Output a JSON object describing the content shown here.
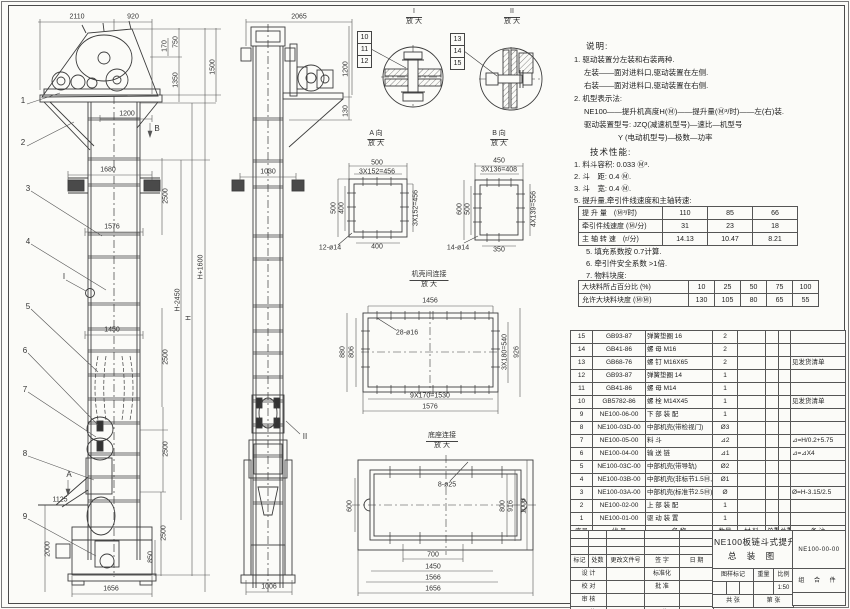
{
  "views": {
    "detail1": {
      "label": "I",
      "mag": "放 大"
    },
    "detail2": {
      "label": "II",
      "mag": "放 大"
    },
    "viewA": {
      "label": "A 向",
      "mag": "放 大"
    },
    "viewB": {
      "label": "B 向",
      "mag": "放 大"
    },
    "case_joint": {
      "label": "机壳间连接",
      "mag": "放 大"
    },
    "base_joint": {
      "label": "底座连接",
      "mag": "放 大"
    }
  },
  "markers": {
    "i": "I",
    "ii": "II",
    "a": "A",
    "b": "B"
  },
  "balloons": {
    "n1": "1",
    "n2": "2",
    "n3": "3",
    "n4": "4",
    "n5": "5",
    "n6": "6",
    "n7": "7",
    "n8": "8",
    "n9": "9",
    "n10": "10",
    "n11": "11",
    "n12": "12",
    "n13": "13",
    "n14": "14",
    "n15": "15"
  },
  "dims": {
    "fv_2110": "2110",
    "fv_920": "920",
    "fv_170": "170",
    "fv_750": "750",
    "fv_1350": "1350",
    "fv_1500": "1500",
    "fv_1200": "1200",
    "fv_1680": "1680",
    "fv_2500a": "2500",
    "fv_1576": "1576",
    "fv_h1600": "H+1600",
    "fv_h2450": "H-2450",
    "fv_h": "H",
    "fv_1450": "1450",
    "fv_2500b": "2500",
    "fv_2500c": "2500",
    "fv_2500d": "2500",
    "fv_850": "850",
    "fv_1125": "1125",
    "fv_2000": "2000",
    "fv_1656": "1656",
    "sv_2065": "2065",
    "sv_1200": "1200",
    "sv_130": "130",
    "sv_1030": "1030",
    "sv_1006": "1006",
    "va_500t": "500",
    "va_456t": "3X152=456",
    "va_500l": "500",
    "va_400l": "400",
    "va_456r": "3X152=456",
    "va_hole": "12-ø14",
    "va_400b": "400",
    "vb_450": "450",
    "vb_408": "3X136=408",
    "vb_600": "600",
    "vb_500": "500",
    "vb_556": "4X139=556",
    "vb_hole": "14-ø14",
    "vb_350": "350",
    "cj_1456": "1456",
    "cj_hole": "28-ø16",
    "cj_880": "880",
    "cj_806": "806",
    "cj_540": "3X180=540",
    "cj_926": "926",
    "cj_1530": "9X170=1530",
    "cj_1576": "1576",
    "bj_hole": "8-ø25",
    "bj_600": "600",
    "bj_800": "800",
    "bj_916": "916",
    "bj_1006": "1006",
    "bj_700": "700",
    "bj_1450": "1450",
    "bj_1566": "1566",
    "bj_1656": "1656"
  },
  "notes": {
    "title": "说明:",
    "lines": [
      "1. 驱动装置分左装和右装两种.",
      "左装——面对进料口,驱动装置在左侧.",
      "右装——面对进料口,驱动装置在右侧.",
      "2. 机型表示法:",
      "NE100——提升机高度H(Ⓜ)——提升量(Ⓜ³/时)——左(右)装.",
      "驱动装置型号: JZQ(减速机型号)—速比—机型号",
      "Y (电动机型号)—极数—功率"
    ]
  },
  "tech": {
    "title": "技术性能:",
    "items_before": [
      "1. 料斗容积: 0.033 Ⓜ³.",
      "2. 斗　距: 0.4 Ⓜ.",
      "3. 斗　宽: 0.4 Ⓜ.",
      "5. 提升量,牵引件线速度和主轴转速:"
    ],
    "table1": {
      "rows": [
        {
          "label": "提 升 量　(Ⓜ³/时)",
          "v": [
            "110",
            "85",
            "66"
          ]
        },
        {
          "label": "牵引件线速度 (Ⓜ/分)",
          "v": [
            "31",
            "23",
            "18"
          ]
        },
        {
          "label": "主 轴 转 速　(r/分)",
          "v": [
            "14.13",
            "10.47",
            "8.21"
          ]
        }
      ]
    },
    "items_mid": [
      "5. 填充系数按 0.7计算.",
      "6. 牵引件安全系数 >1倍.",
      "7. 物料块度:"
    ],
    "table2": {
      "rows": [
        {
          "label": "大块料所占百分比 (%)",
          "v": [
            "10",
            "25",
            "50",
            "75",
            "100"
          ]
        },
        {
          "label": "允许大块料块度 (ⓂⓂ)",
          "v": [
            "130",
            "105",
            "80",
            "65",
            "55"
          ]
        }
      ]
    }
  },
  "bom": {
    "header": [
      "序号",
      "代  号",
      "名    称",
      "数量",
      "材  料",
      "单重",
      "总重",
      "备  注"
    ],
    "rows": [
      {
        "no": "15",
        "code": "GB93-87",
        "name": "弹簧垫圈 16",
        "qty": "2",
        "rm": ""
      },
      {
        "no": "14",
        "code": "GB41-86",
        "name": "螺 母 M16",
        "qty": "2",
        "rm": ""
      },
      {
        "no": "13",
        "code": "GB68-76",
        "name": "螺 钉 M16X65",
        "qty": "2",
        "rm": "见发货清单"
      },
      {
        "no": "12",
        "code": "GB93-87",
        "name": "弹簧垫圈 14",
        "qty": "1",
        "rm": ""
      },
      {
        "no": "11",
        "code": "GB41-86",
        "name": "螺 母 M14",
        "qty": "1",
        "rm": ""
      },
      {
        "no": "10",
        "code": "GB5782-86",
        "name": "螺 栓 M14X45",
        "qty": "1",
        "rm": "见发货清单"
      },
      {
        "no": "9",
        "code": "NE100-06-00",
        "name": "下 部 装 配",
        "qty": "1",
        "rm": ""
      },
      {
        "no": "8",
        "code": "NE100-03D-00",
        "name": "中部机壳(带检视门)",
        "qty": "Ø3",
        "rm": ""
      },
      {
        "no": "7",
        "code": "NE100-05-00",
        "name": "料 斗",
        "qty": "⊿2",
        "rm": "⊿=H/0.2+5.75"
      },
      {
        "no": "6",
        "code": "NE100-04-00",
        "name": "输 送 链",
        "qty": "⊿1",
        "rm": "⊿=⊿X4"
      },
      {
        "no": "5",
        "code": "NE100-03C-00",
        "name": "中部机壳(带导轨)",
        "qty": "Ø2",
        "rm": ""
      },
      {
        "no": "4",
        "code": "NE100-03B-00",
        "name": "中部机壳(非标节1.5Ⓜ,1Ⓜ)",
        "qty": "Ø1",
        "rm": ""
      },
      {
        "no": "3",
        "code": "NE100-03A-00",
        "name": "中部机壳(标准节2.5Ⓜ)",
        "qty": "Ø",
        "rm": "Ø=H-3.15/2.5"
      },
      {
        "no": "2",
        "code": "NE100-02-00",
        "name": "上 部 装 配",
        "qty": "1",
        "rm": ""
      },
      {
        "no": "1",
        "code": "NE100-01-00",
        "name": "驱 动 装 置",
        "qty": "1",
        "rm": ""
      }
    ]
  },
  "titleblock": {
    "product": "NE100板链斗式提升机",
    "doc_type": "总 装 图",
    "drawing_no": "NE100-00-00",
    "part_class": "组 合 件",
    "rev_header": [
      "标记",
      "处数",
      "更改文件号",
      "签 字",
      "日 期"
    ],
    "roles": {
      "design": "设 计",
      "check": "校 对",
      "review": "审 核",
      "craft": "工 艺",
      "std": "标准化",
      "approve": "批 准",
      "date_label": "日 期",
      "date": "97.7"
    },
    "stamp": {
      "mark": "图样标记",
      "weight": "重量",
      "scale_label": "比例",
      "scale": "1:50"
    },
    "sheets": {
      "total": "共  张",
      "page": "第  张"
    }
  }
}
